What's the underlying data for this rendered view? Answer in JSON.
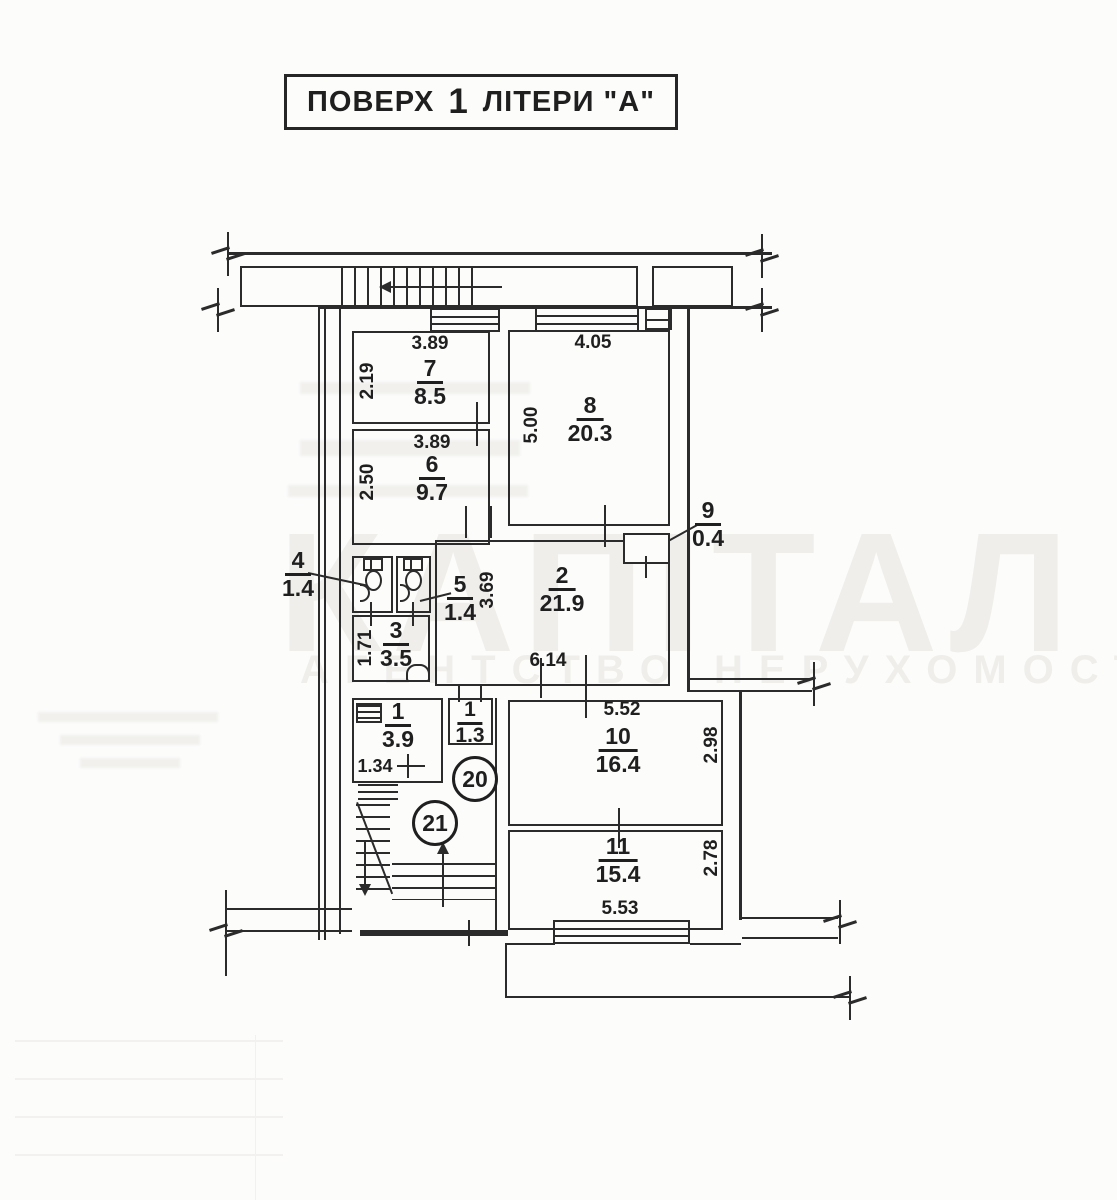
{
  "title": {
    "text_left": "ПОВЕРХ",
    "floor_number": "1",
    "text_right": "ЛІТЕРИ \"А\""
  },
  "watermark": {
    "line1": "КАПІТАЛ",
    "line2": "АГЕНТСТВО НЕРУХОМОСТІ"
  },
  "apartments": [
    "20",
    "21"
  ],
  "rooms": [
    {
      "number": "7",
      "area": "8.5",
      "width_dim": "3.89",
      "height_dim": "2.19"
    },
    {
      "number": "6",
      "area": "9.7",
      "width_dim": "3.89",
      "height_dim": "2.50"
    },
    {
      "number": "8",
      "area": "20.3",
      "width_dim": "4.05",
      "height_dim": "5.00"
    },
    {
      "number": "2",
      "area": "21.9",
      "width_dim": "6.14",
      "height_dim": "3.69"
    },
    {
      "number": "9",
      "area": "0.4"
    },
    {
      "number": "4",
      "area": "1.4"
    },
    {
      "number": "5",
      "area": "1.4"
    },
    {
      "number": "3",
      "area": "3.5",
      "height_dim": "1.71"
    },
    {
      "number": "1",
      "area": "3.9",
      "width_dim": "1.34"
    },
    {
      "number": "1",
      "area": "1.3"
    },
    {
      "number": "10",
      "area": "16.4",
      "width_dim": "5.52",
      "height_dim": "2.98"
    },
    {
      "number": "11",
      "area": "15.4",
      "width_dim": "5.53",
      "height_dim": "2.78"
    }
  ],
  "colors": {
    "ink": "#2b2b2b",
    "paper": "#fcfcfb",
    "watermark": "#efeeeb"
  }
}
